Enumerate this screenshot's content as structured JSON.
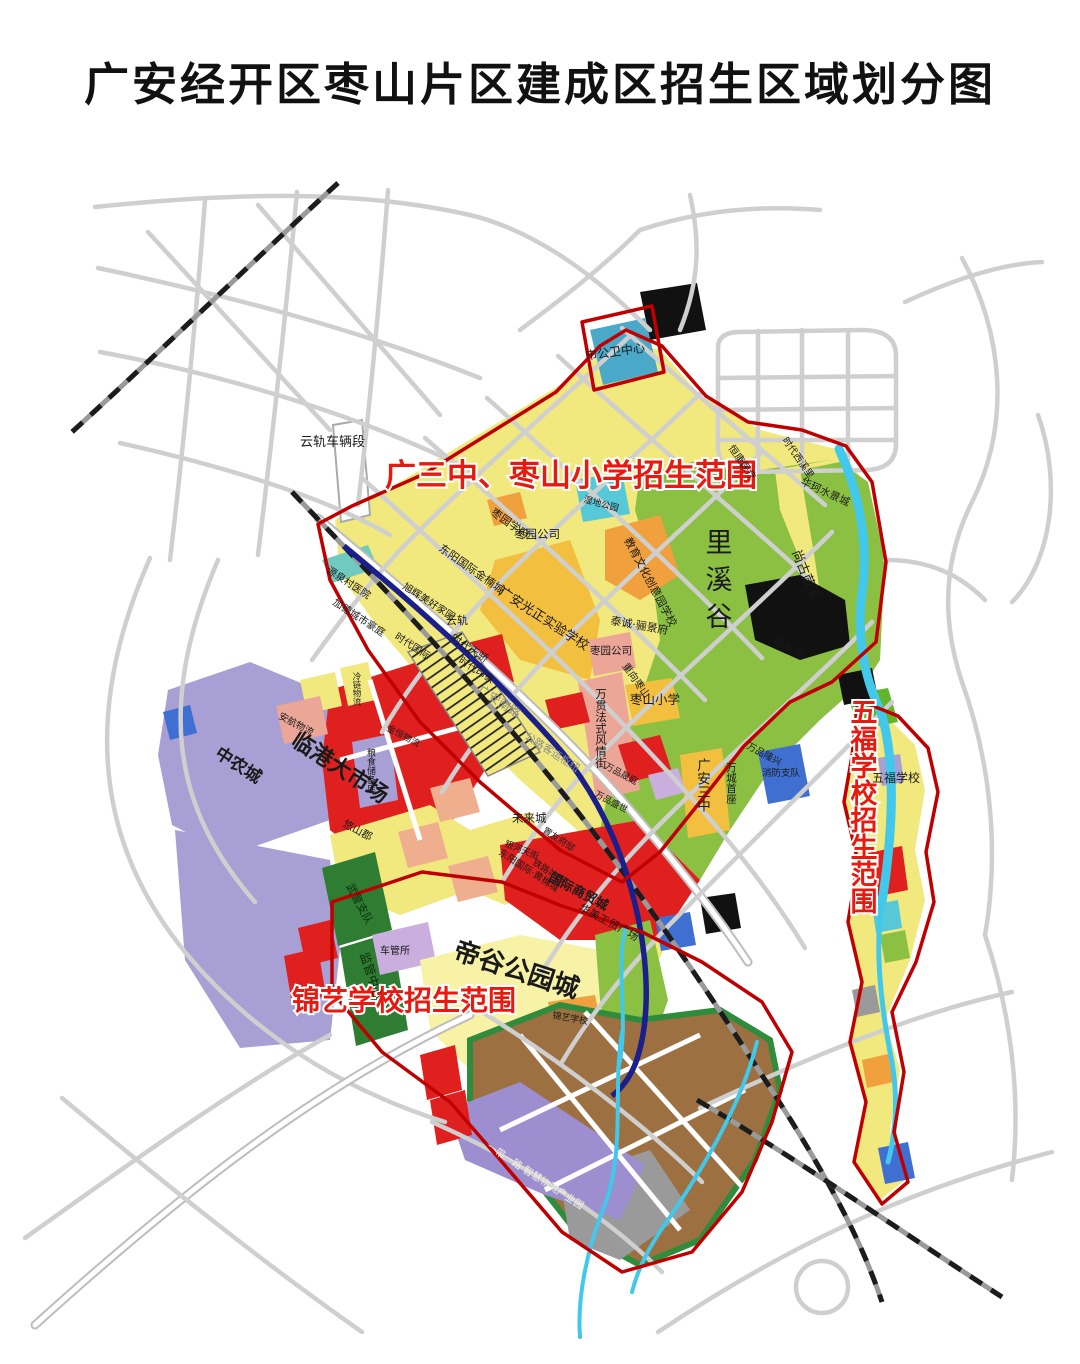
{
  "title": "广安经开区枣山片区建成区招生区域划分图",
  "zones": {
    "zone1": "广三中、枣山小学招生范围",
    "zone2": "五福学校招生范围",
    "zone3": "锦艺学校招生范围",
    "boundary_color": "#c00000",
    "label_color": "#e8190f"
  },
  "labels": {
    "digu": "帝谷公园城",
    "lixigu": "里溪谷",
    "yungui_depot": "云轨车辆段",
    "public_health": "市公卫中心",
    "shidi": "湿地公园",
    "hengkang": "恒康医疗",
    "xixili": "时代西溪里",
    "huake": "华珂水景城",
    "shanggu": "尚古茴溪",
    "huashuiwan": "花水湾",
    "zaoyuan_xuefu": "枣园学府",
    "dongyang_jinnan": "东阳国际金楠城",
    "zaoyuan1": "枣园公司",
    "guangzheng": "广安光正实验学校",
    "jiaoyu": "教育文化创意园学校",
    "taicheng": "泰诚·骊景府",
    "zaoyuan2": "枣园公司",
    "chongxiang": "重向枣山",
    "zaoshan_xiaoxue": "枣山小学",
    "yuanquan": "源泉村医院",
    "jiade": "加德城市豪庭",
    "xuhui": "旭辉美好家园",
    "sd_guoji": "时代国际",
    "sd_tianjiao": "时代天骄",
    "sd_yinxiang": "时代印象",
    "wanguan": "万贯法式风情街",
    "gn_road": "广安南路",
    "keyun": "公路客运枢纽",
    "yungui": "云轨",
    "weilai": "未来城",
    "yinhe": "银河天街",
    "zhanchang": "铁路站场",
    "shangmao": "国际商贸城",
    "gongmao": "华美工贸广场",
    "sanzhong": "广安三中",
    "wancheng": "万城首座",
    "xiaofang": "消防支队",
    "wp1": "万品隆兴",
    "wp2": "万品晟庭",
    "wp3": "万品盛世",
    "dongyang_hj": "东阳国际·黄桷城",
    "zhiyou": "置友府邸",
    "zhongnong": "中农城",
    "lingang": "临港大市场",
    "anhang": "安航物流",
    "liangku": "粮食储备库",
    "lenglian": "冷链物流",
    "jinheng": "金恒物流",
    "youshanjun": "悠山郡",
    "wujing": "武警支队",
    "jianguan": "监管中心",
    "cheguan": "车管所",
    "jinyi": "锦艺学校",
    "yidai": "一带一路·智慧物流产业园",
    "wufu": "五福学校"
  },
  "colors": {
    "park_green": "#8bc043",
    "parcel_yellow": "#f1e87e",
    "commercial_red": "#e01f1f",
    "metro_blue": "#1b1f8c",
    "water_cyan": "#41c8ea"
  }
}
